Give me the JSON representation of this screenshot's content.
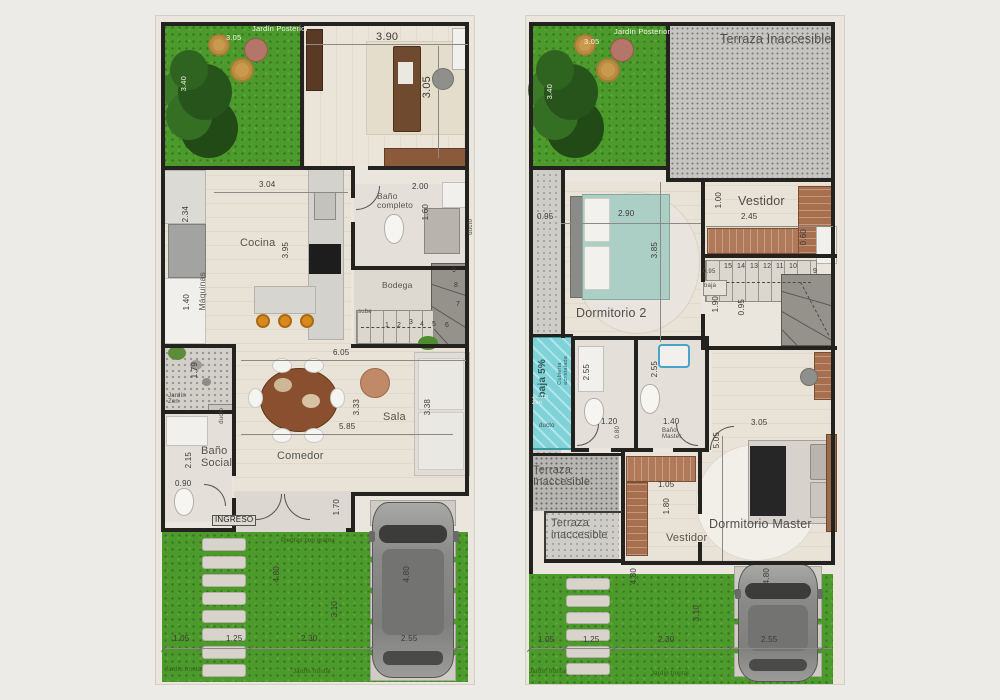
{
  "meta": {
    "colors": {
      "grass": "#4d9a2c",
      "concrete": "#c6c5c2",
      "wood_floor": "#e9e3d7",
      "wall": "#23221f",
      "closet_wood": "#b0795a",
      "glass_roof": "#7ed2d8",
      "stool_orange": "#d8891e",
      "bed_teal": "#abcfc5",
      "paper": "#eae5dd"
    }
  },
  "floor1": {
    "labels": [
      {
        "text": "Jardín Posterior",
        "x": 96,
        "y": 9,
        "cls": "white",
        "name": "jardin-posterior-label"
      },
      {
        "text": "3.05",
        "x": 70,
        "y": 18,
        "cls": "white"
      },
      {
        "text": "3.40",
        "x": 24,
        "y": 60,
        "cls": "white",
        "rot": 1
      },
      {
        "text": "3.90",
        "x": 220,
        "y": 16,
        "cls": "dimlg"
      },
      {
        "text": "3.05",
        "x": 266,
        "y": 60,
        "cls": "dimlg",
        "rot": 1
      },
      {
        "text": "3.04",
        "x": 103,
        "y": 165,
        "cls": "dim"
      },
      {
        "text": "2.34",
        "x": 26,
        "y": 190,
        "cls": "dim",
        "rot": 1
      },
      {
        "text": "Cocina",
        "x": 84,
        "y": 222,
        "cls": "room",
        "name": "cocina-label"
      },
      {
        "text": "3.95",
        "x": 126,
        "y": 226,
        "cls": "dim",
        "rot": 1
      },
      {
        "text": "Máquinas",
        "x": 42,
        "y": 256,
        "cls": "small",
        "rot": 1,
        "name": "maquinas-label"
      },
      {
        "text": "1.40",
        "x": 27,
        "y": 278,
        "cls": "dim",
        "rot": 1
      },
      {
        "text": "Baño\ncompleto",
        "x": 221,
        "y": 176,
        "cls": "small",
        "name": "bano-completo-label"
      },
      {
        "text": "2.00",
        "x": 256,
        "y": 167,
        "cls": "dim"
      },
      {
        "text": "1.60",
        "x": 266,
        "y": 188,
        "cls": "dim",
        "rot": 1
      },
      {
        "text": "Bodega",
        "x": 226,
        "y": 265,
        "cls": "small",
        "name": "bodega-label"
      },
      {
        "text": "sube",
        "x": 202,
        "y": 293,
        "cls": "tiny",
        "name": "sube-label"
      },
      {
        "text": "1",
        "x": 229,
        "y": 306,
        "cls": "stair"
      },
      {
        "text": "2",
        "x": 241,
        "y": 306,
        "cls": "stair"
      },
      {
        "text": "3",
        "x": 253,
        "y": 303,
        "cls": "stair"
      },
      {
        "text": "4",
        "x": 264,
        "y": 305,
        "cls": "stair"
      },
      {
        "text": "5",
        "x": 276,
        "y": 305,
        "cls": "stair"
      },
      {
        "text": "6",
        "x": 289,
        "y": 306,
        "cls": "stair"
      },
      {
        "text": "7",
        "x": 300,
        "y": 285,
        "cls": "stair"
      },
      {
        "text": "8",
        "x": 298,
        "y": 266,
        "cls": "stair"
      },
      {
        "text": "9",
        "x": 296,
        "y": 251,
        "cls": "stair"
      },
      {
        "text": "1.79",
        "x": 35,
        "y": 346,
        "cls": "dim",
        "rot": 1
      },
      {
        "text": "Jardín\nZen",
        "x": 12,
        "y": 377,
        "cls": "tiny",
        "name": "jardin-zen-label"
      },
      {
        "text": "ducto",
        "x": 63,
        "y": 392,
        "cls": "tiny",
        "rot": 1,
        "name": "ducto-label"
      },
      {
        "text": "ducto",
        "x": 312,
        "y": 203,
        "cls": "tiny",
        "rot": 1,
        "name": "ducto-label"
      },
      {
        "text": "Baño\nSocial",
        "x": 45,
        "y": 430,
        "cls": "room",
        "name": "bano-social-label"
      },
      {
        "text": "2.15",
        "x": 29,
        "y": 436,
        "cls": "dim",
        "rot": 1
      },
      {
        "text": "0.90",
        "x": 19,
        "y": 464,
        "cls": "dim"
      },
      {
        "text": "6.05",
        "x": 177,
        "y": 333,
        "cls": "dim"
      },
      {
        "text": "5.85",
        "x": 183,
        "y": 407,
        "cls": "dim"
      },
      {
        "text": "3.33",
        "x": 197,
        "y": 383,
        "cls": "dim",
        "rot": 1
      },
      {
        "text": "Sala",
        "x": 227,
        "y": 396,
        "cls": "room",
        "name": "sala-label"
      },
      {
        "text": "3.38",
        "x": 268,
        "y": 383,
        "cls": "dim",
        "rot": 1
      },
      {
        "text": "Comedor",
        "x": 121,
        "y": 435,
        "cls": "room",
        "name": "comedor-label"
      },
      {
        "text": "INGRESO",
        "x": 56,
        "y": 499,
        "cls": "badge",
        "name": "ingreso-sign"
      },
      {
        "text": "1.70",
        "x": 177,
        "y": 483,
        "cls": "dim",
        "rot": 1
      },
      {
        "text": "Piedras con grama",
        "x": 125,
        "y": 522,
        "cls": "greent",
        "name": "garden-note"
      },
      {
        "text": "4.80",
        "x": 117,
        "y": 550,
        "cls": "dim",
        "rot": 1
      },
      {
        "text": "3.10",
        "x": 175,
        "y": 585,
        "cls": "dim",
        "rot": 1
      },
      {
        "text": "4.80",
        "x": 247,
        "y": 550,
        "cls": "dim",
        "rot": 1
      },
      {
        "text": "1.05",
        "x": 17,
        "y": 619,
        "cls": "dim"
      },
      {
        "text": "1.25",
        "x": 70,
        "y": 619,
        "cls": "dim"
      },
      {
        "text": "2.30",
        "x": 145,
        "y": 619,
        "cls": "dim"
      },
      {
        "text": "2.55",
        "x": 245,
        "y": 619,
        "cls": "dim"
      },
      {
        "text": "Jardín frontal",
        "x": 9,
        "y": 651,
        "cls": "greent",
        "name": "jardin-frontal-label"
      },
      {
        "text": "Jardín frontal",
        "x": 137,
        "y": 653,
        "cls": "greent",
        "name": "jardin-frontal-label"
      }
    ]
  },
  "floor2": {
    "labels": [
      {
        "text": "Jardín Posterior",
        "x": 88,
        "y": 12,
        "cls": "white",
        "name": "jardin-posterior-label"
      },
      {
        "text": "3.05",
        "x": 58,
        "y": 22,
        "cls": "white"
      },
      {
        "text": "3.40",
        "x": 20,
        "y": 68,
        "cls": "white",
        "rot": 1
      },
      {
        "text": "Terraza Inaccesible",
        "x": 194,
        "y": 17,
        "cls": "roomlg",
        "name": "terraza-inaccesible-label"
      },
      {
        "text": "0.95",
        "x": 11,
        "y": 197,
        "cls": "dim"
      },
      {
        "text": "2.90",
        "x": 92,
        "y": 194,
        "cls": "dim"
      },
      {
        "text": "3.85",
        "x": 125,
        "y": 226,
        "cls": "dim",
        "rot": 1
      },
      {
        "text": "Dormitorio 2",
        "x": 50,
        "y": 291,
        "cls": "roomlg",
        "name": "dormitorio-2-label"
      },
      {
        "text": "Vestidor",
        "x": 212,
        "y": 179,
        "cls": "roomlg",
        "name": "vestidor-label"
      },
      {
        "text": "2.45",
        "x": 215,
        "y": 197,
        "cls": "dim"
      },
      {
        "text": "1.00",
        "x": 189,
        "y": 176,
        "cls": "dim",
        "rot": 1
      },
      {
        "text": "0.60",
        "x": 274,
        "y": 213,
        "cls": "dim",
        "rot": 1
      },
      {
        "text": "15",
        "x": 198,
        "y": 247,
        "cls": "stair"
      },
      {
        "text": "14",
        "x": 211,
        "y": 247,
        "cls": "stair"
      },
      {
        "text": "13",
        "x": 224,
        "y": 247,
        "cls": "stair"
      },
      {
        "text": "12",
        "x": 237,
        "y": 247,
        "cls": "stair"
      },
      {
        "text": "11",
        "x": 250,
        "y": 247,
        "cls": "stair"
      },
      {
        "text": "10",
        "x": 263,
        "y": 247,
        "cls": "stair"
      },
      {
        "text": "9",
        "x": 287,
        "y": 252,
        "cls": "stair"
      },
      {
        "text": "0.95",
        "x": 177,
        "y": 253,
        "cls": "tiny"
      },
      {
        "text": "baja",
        "x": 178,
        "y": 267,
        "cls": "tiny",
        "name": "baja-label"
      },
      {
        "text": "1.90",
        "x": 186,
        "y": 280,
        "cls": "dim",
        "rot": 1
      },
      {
        "text": "0.95",
        "x": 212,
        "y": 283,
        "cls": "dim",
        "rot": 1
      },
      {
        "text": "baja 5%",
        "x": 12,
        "y": 343,
        "cls": "tealbig",
        "rot": 1,
        "name": "baja-5-label"
      },
      {
        "text": "Cubierta\nacristalada",
        "x": 32,
        "y": 340,
        "cls": "tealsmall",
        "rot": 1,
        "name": "cubierta-acristalada-label"
      },
      {
        "text": "Jardín\nZen",
        "x": 6,
        "y": 379,
        "cls": "tinywhite",
        "name": "jardin-zen-label"
      },
      {
        "text": "ducto",
        "x": 13,
        "y": 407,
        "cls": "tiny",
        "name": "ducto-label"
      },
      {
        "text": "2.55",
        "x": 57,
        "y": 348,
        "cls": "dim",
        "rot": 1
      },
      {
        "text": "2.55",
        "x": 125,
        "y": 345,
        "cls": "dim",
        "rot": 1
      },
      {
        "text": "1.20",
        "x": 75,
        "y": 402,
        "cls": "dim"
      },
      {
        "text": "0.80",
        "x": 89,
        "y": 410,
        "cls": "tiny",
        "rot": 1
      },
      {
        "text": "1.40",
        "x": 137,
        "y": 402,
        "cls": "dim"
      },
      {
        "text": "Baño\nMaster",
        "x": 136,
        "y": 412,
        "cls": "tiny",
        "name": "bano-master-label"
      },
      {
        "text": "3.05",
        "x": 225,
        "y": 403,
        "cls": "dim"
      },
      {
        "text": "5.05",
        "x": 187,
        "y": 416,
        "cls": "dim",
        "rot": 1
      },
      {
        "text": "1.05",
        "x": 132,
        "y": 465,
        "cls": "dim"
      },
      {
        "text": "1.80",
        "x": 137,
        "y": 482,
        "cls": "dim",
        "rot": 1
      },
      {
        "text": "Vestidor",
        "x": 140,
        "y": 517,
        "cls": "room",
        "name": "vestidor-master-label"
      },
      {
        "text": "Dormitorio Master",
        "x": 183,
        "y": 502,
        "cls": "roomlg",
        "name": "dormitorio-master-label"
      },
      {
        "text": "Terraza\nInaccesible",
        "x": 7,
        "y": 449,
        "cls": "room",
        "name": "terraza-inaccesible-label"
      },
      {
        "text": "Terraza\ninaccesible",
        "x": 25,
        "y": 502,
        "cls": "room",
        "name": "terraza-inaccesible-label"
      },
      {
        "text": "4.80",
        "x": 104,
        "y": 552,
        "cls": "dim",
        "rot": 1
      },
      {
        "text": "3.10",
        "x": 167,
        "y": 589,
        "cls": "dim",
        "rot": 1
      },
      {
        "text": "4.80",
        "x": 237,
        "y": 552,
        "cls": "dim",
        "rot": 1
      },
      {
        "text": "1.05",
        "x": 12,
        "y": 620,
        "cls": "dim"
      },
      {
        "text": "1.25",
        "x": 57,
        "y": 620,
        "cls": "dim"
      },
      {
        "text": "2.30",
        "x": 132,
        "y": 620,
        "cls": "dim"
      },
      {
        "text": "2.55",
        "x": 235,
        "y": 620,
        "cls": "dim"
      },
      {
        "text": "Jardín frontal",
        "x": 3,
        "y": 653,
        "cls": "greent",
        "name": "jardin-frontal-label"
      },
      {
        "text": "Jardín frontal",
        "x": 125,
        "y": 655,
        "cls": "greent",
        "name": "jardin-frontal-label"
      }
    ]
  }
}
